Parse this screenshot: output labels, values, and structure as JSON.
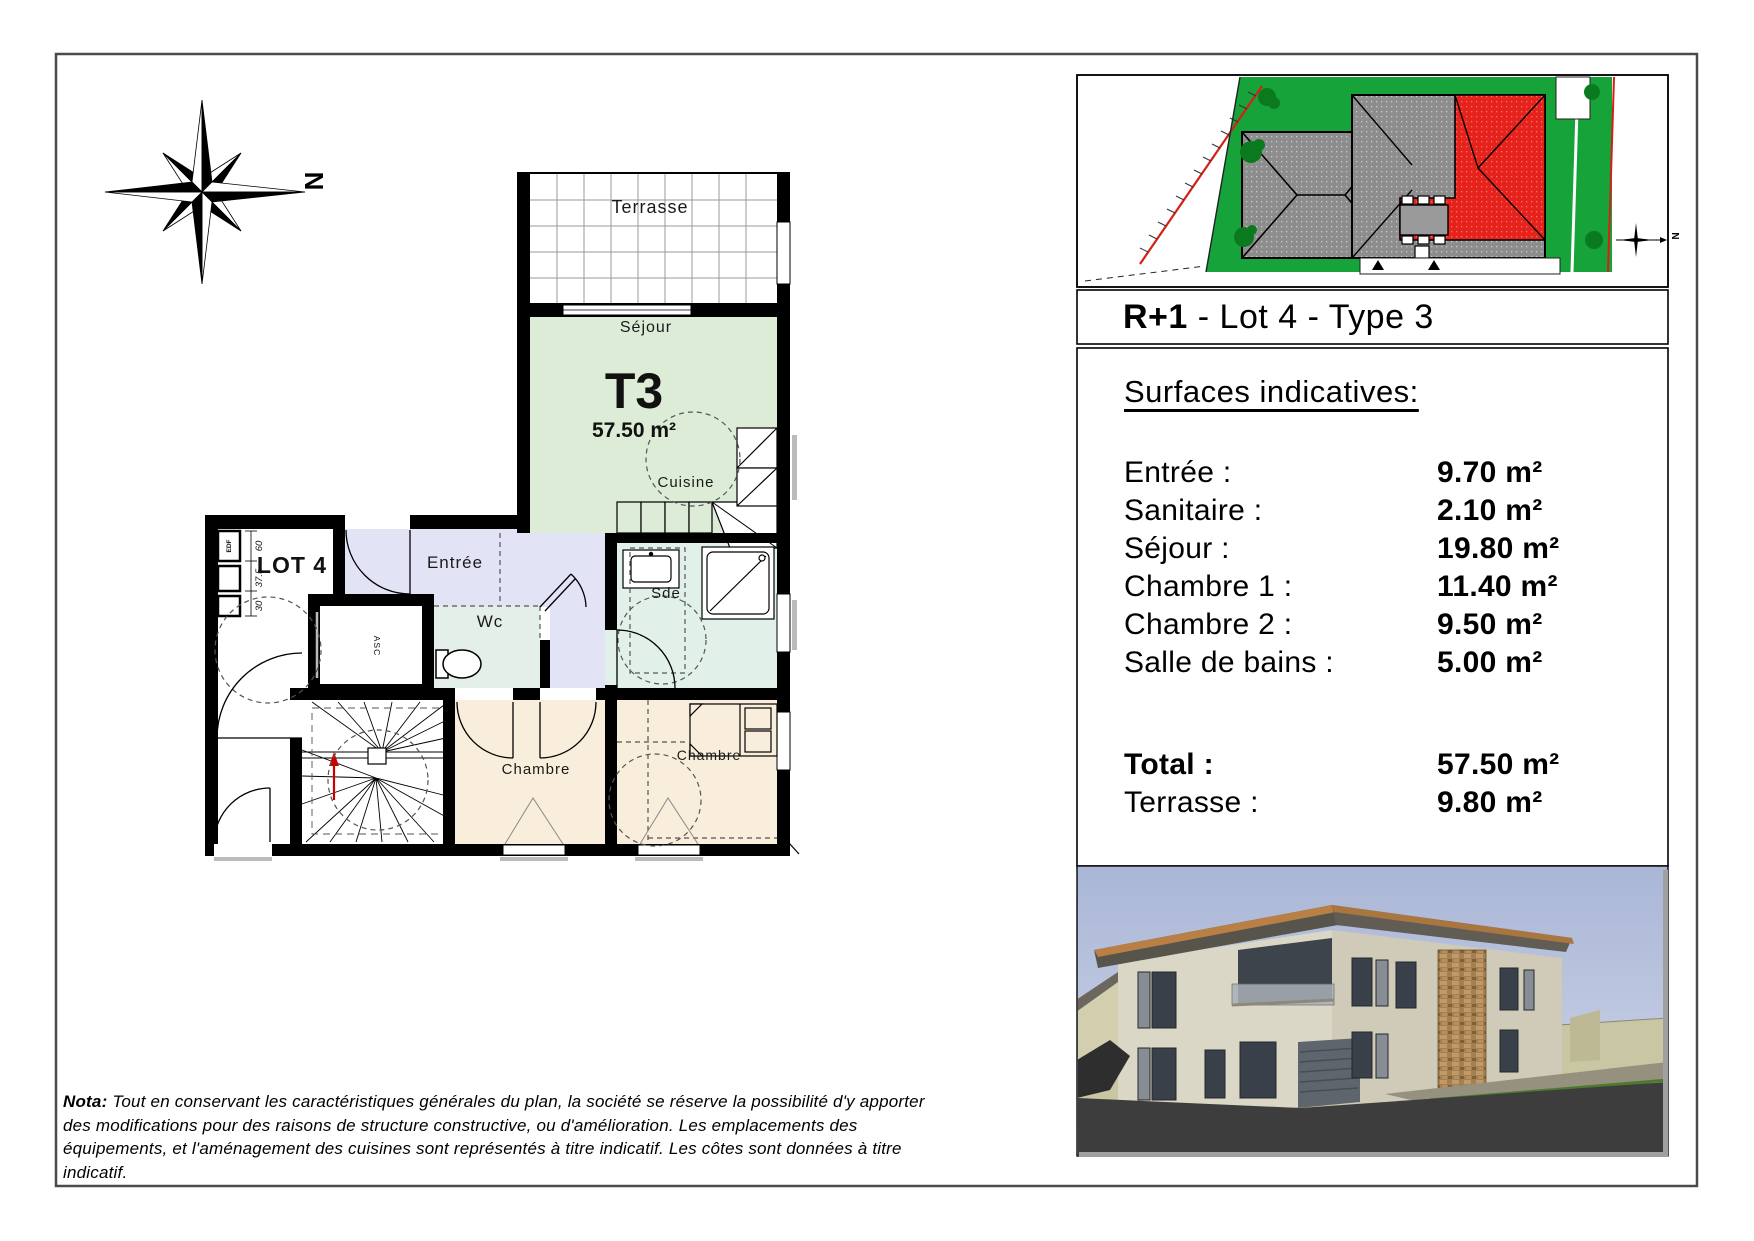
{
  "page": {
    "title_bold": "R+1",
    "title_rest": " - Lot 4 - Type 3"
  },
  "compass": {
    "north": "N"
  },
  "site_plan": {
    "north": "N"
  },
  "floor_plan": {
    "lot": "LOT 4",
    "type": "T3",
    "area": "57.50 m²",
    "rooms": {
      "terrasse": "Terrasse",
      "sejour": "Séjour",
      "cuisine": "Cuisine",
      "entree": "Entrée",
      "wc": "Wc",
      "sde": "Sde",
      "chambre1": "Chambre",
      "chambre2": "Chambre",
      "asc": "ASC"
    },
    "dims": {
      "edf": "EDF",
      "d1": "60",
      "d2": "37.5",
      "d3": "30"
    }
  },
  "surfaces": {
    "heading": "Surfaces indicatives:",
    "rows": [
      {
        "label": "Entrée :",
        "value": "9.70 m²"
      },
      {
        "label": "Sanitaire :",
        "value": "2.10 m²"
      },
      {
        "label": "Séjour :",
        "value": "19.80 m²"
      },
      {
        "label": "Chambre 1 :",
        "value": "11.40 m²"
      },
      {
        "label": "Chambre 2 :",
        "value": "9.50 m²"
      },
      {
        "label": "Salle de bains :",
        "value": "5.00 m²"
      }
    ],
    "total_row": {
      "label": "Total :",
      "value": "57.50 m²"
    },
    "terrace_row": {
      "label": "Terrasse :",
      "value": "9.80 m²"
    }
  },
  "nota": {
    "prefix": "Nota:",
    "body": " Tout en conservant les caractéristiques générales du plan, la société se réserve la possibilité d'y apporter des modifications pour des raisons de structure constructive, ou d'amélioration. Les emplacements des équipements, et l'aménagement des cuisines sont représentés à titre indicatif. Les côtes sont données à titre indicatif."
  },
  "colors": {
    "site_green": "#16a33a",
    "highlight_red": "#e6221c",
    "sejour_fill": "#dcecd7",
    "entree_fill": "#e3e3f6",
    "sde_fill": "#e2f0ea",
    "chambre_fill": "#f9eedb",
    "wall": "#000000"
  }
}
